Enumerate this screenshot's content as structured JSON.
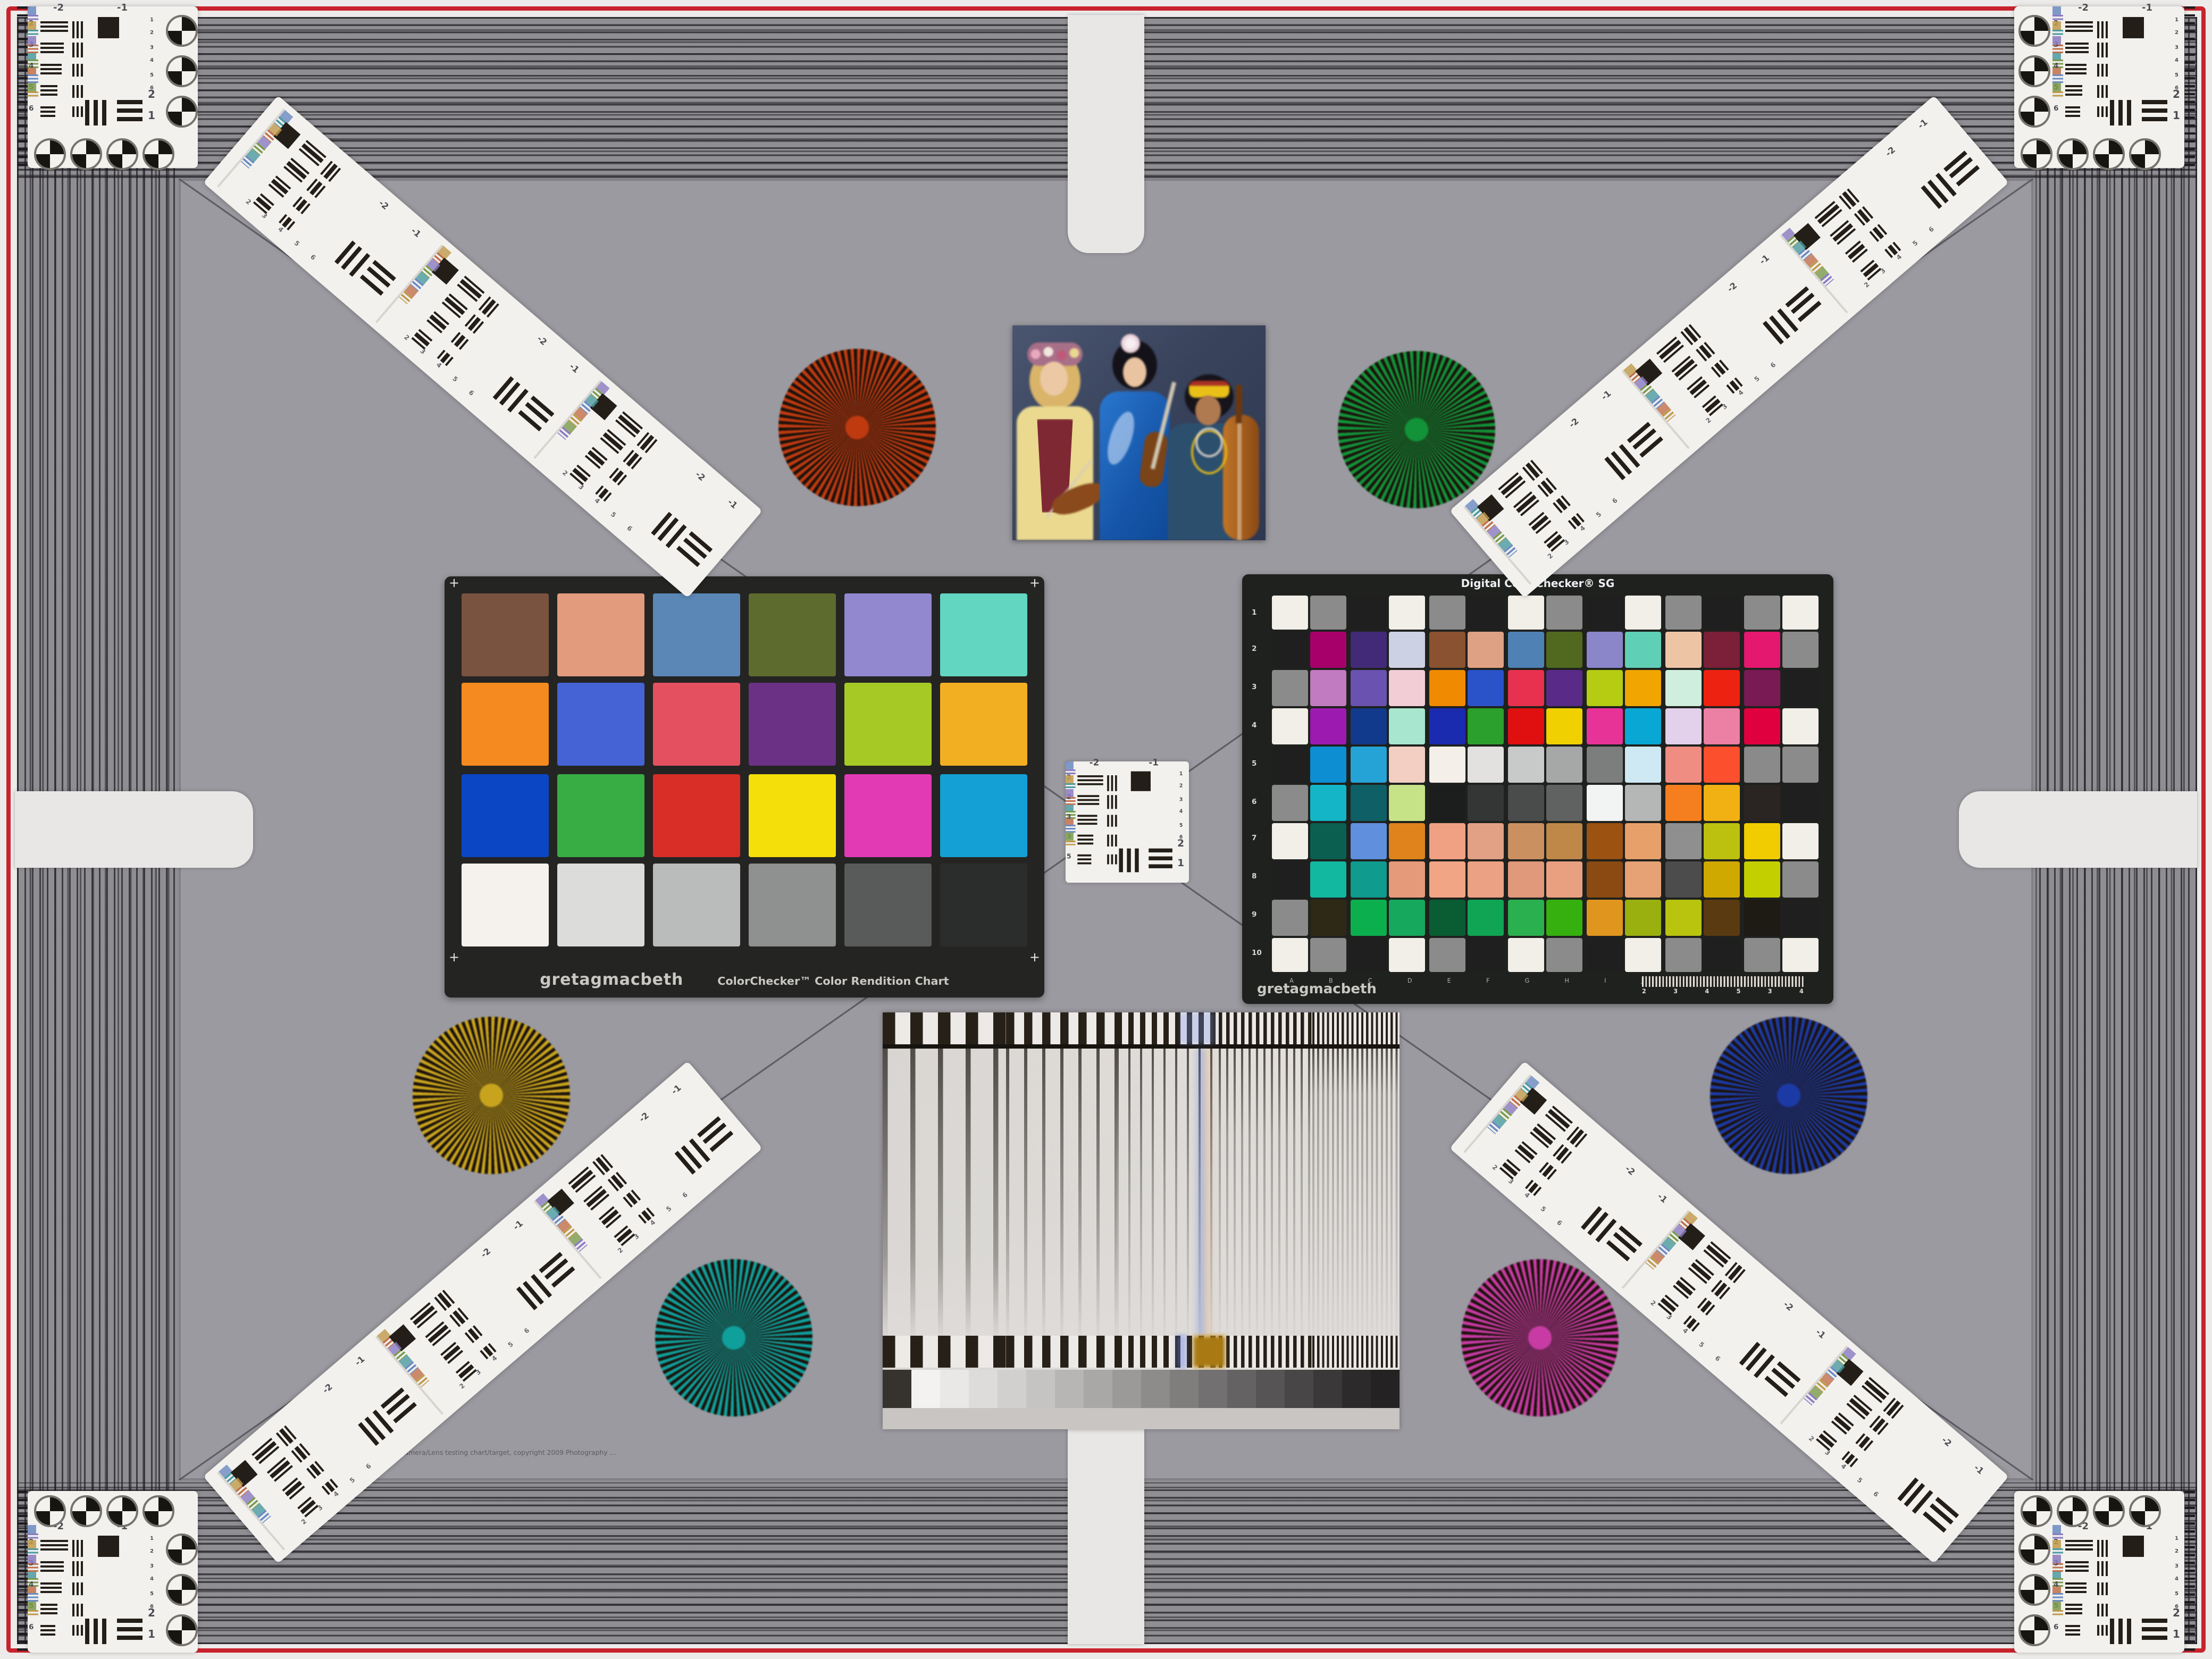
{
  "page": {
    "type": "camera-lens-test-chart"
  },
  "colors": {
    "frame_red": "#c8232c",
    "background_gray": "#8f8e93",
    "inner_gray": "#9b9aa0",
    "panel_white": "#f3f1ed",
    "chart_frame_black": "#242423"
  },
  "classic_checker": {
    "brand": "gretagmacbeth",
    "title": "ColorChecker™ Color Rendition Chart",
    "corner_marks": "+",
    "rows": [
      [
        "#7a5240",
        "#e29b7d",
        "#5a87b5",
        "#5d6b2e",
        "#9288cf",
        "#62d6c0"
      ],
      [
        "#f58a20",
        "#4663d5",
        "#e55060",
        "#6b3184",
        "#a6c926",
        "#f3af22"
      ],
      [
        "#0b46c4",
        "#38ad43",
        "#d92e28",
        "#f5df0a",
        "#e23ab4",
        "#14a0d4"
      ],
      [
        "#f5f2ed",
        "#dcdcda",
        "#b9bcbb",
        "#8e918f",
        "#585b59",
        "#2b2d2c"
      ]
    ]
  },
  "sg_checker": {
    "title": "Digital ColorChecker® SG",
    "brand": "gretagmacbeth",
    "row_labels": [
      "1",
      "2",
      "3",
      "4",
      "5",
      "6",
      "7",
      "8",
      "9",
      "10"
    ],
    "col_labels": [
      "A",
      "B",
      "C",
      "D",
      "E",
      "F",
      "G",
      "H",
      "I",
      "J",
      "K",
      "L",
      "M",
      "N"
    ],
    "wedge_numbers": [
      "2",
      "3",
      "4",
      "5",
      "3",
      "4"
    ],
    "rows": [
      [
        "#f2efe9",
        "#8b8b8b",
        "#1f1f1f",
        "#f2efe9",
        "#8b8b8b",
        "#1f1f1f",
        "#f2efe9",
        "#8b8b8b",
        "#1f1f1f",
        "#f2efe9",
        "#8b8b8b",
        "#1f1f1f",
        "#8b8b8b",
        "#f2efe9"
      ],
      [
        "#1f1f1f",
        "#a8006b",
        "#422a79",
        "#ccd1e3",
        "#8a5230",
        "#dfa183",
        "#4f81b5",
        "#51691f",
        "#8b85c9",
        "#5fd0b6",
        "#eec5a4",
        "#7c1f38",
        "#e3186e",
        "#8b8b8b"
      ],
      [
        "#8b8b8b",
        "#c17bc0",
        "#6a52b0",
        "#f3cdd5",
        "#f08a00",
        "#2a52c9",
        "#e8314e",
        "#5a2a88",
        "#b5cc12",
        "#f0a500",
        "#cfeedd",
        "#ee2211",
        "#7a1a55",
        "#1f1f1f"
      ],
      [
        "#f2efe9",
        "#9c1ab0",
        "#123a8c",
        "#a8e6cf",
        "#1b2bb0",
        "#2ca02c",
        "#e01010",
        "#f0d000",
        "#e73397",
        "#09a8d4",
        "#e3d0ea",
        "#ec7fa4",
        "#e00040",
        "#f2efe9"
      ],
      [
        "#1f1f1f",
        "#0d8ed3",
        "#26a3d6",
        "#f2cfc2",
        "#f4efe9",
        "#e2e1e0",
        "#c8c9c9",
        "#a6a7a7",
        "#7c7d7d",
        "#cfe9f4",
        "#f08d82",
        "#fb4f2e",
        "#8a8a8a",
        "#8b8b8b"
      ],
      [
        "#8b8b8b",
        "#14b5c6",
        "#0e5f66",
        "#c6e387",
        "#1c1e1d",
        "#343635",
        "#4a4c4b",
        "#606262",
        "#f2f4f3",
        "#b5b7b6",
        "#f57f1e",
        "#f2b112",
        "#2a2422",
        "#1f1f1f"
      ],
      [
        "#f2efe9",
        "#0b5f50",
        "#6090dd",
        "#e0831c",
        "#f0a183",
        "#e2a085",
        "#cb9060",
        "#c08848",
        "#9c5210",
        "#e8a06a",
        "#8e8f8e",
        "#bcc110",
        "#f0cc00",
        "#f2efe9"
      ],
      [
        "#1f1f1f",
        "#12b8a0",
        "#0f9b8d",
        "#e59a79",
        "#f2a585",
        "#eba184",
        "#e0997a",
        "#e8a080",
        "#8a4a12",
        "#e6a175",
        "#4c4c4c",
        "#cfa800",
        "#c4cf00",
        "#8b8b8b"
      ],
      [
        "#8b8b8b",
        "#2e2916",
        "#0caf4e",
        "#16a85c",
        "#0a5c32",
        "#0fa554",
        "#2ab04e",
        "#36b00e",
        "#e0951e",
        "#9ab00e",
        "#b8c40e",
        "#5a3a10",
        "#1e1a14",
        "#1f1f1f"
      ],
      [
        "#f2efe9",
        "#8b8b8b",
        "#1f1f1f",
        "#f2efe9",
        "#8b8b8b",
        "#1f1f1f",
        "#f2efe9",
        "#8b8b8b",
        "#1f1f1f",
        "#f2efe9",
        "#8b8b8b",
        "#1f1f1f",
        "#8b8b8b",
        "#f2efe9"
      ]
    ]
  },
  "resolution_targets": {
    "group_labels": [
      "-2",
      "-1"
    ],
    "corner_left_numbers": [
      "2",
      "3",
      "4",
      "5",
      "6"
    ],
    "center_left_numbers": [
      "2",
      "2",
      "3",
      "3",
      "5"
    ],
    "right_numbers": [
      "1",
      "2",
      "3",
      "4",
      "5",
      "6"
    ],
    "bottom_numbers": [
      "2",
      "1"
    ]
  },
  "starbursts": [
    {
      "name": "red",
      "color": "#c03a10"
    },
    {
      "name": "green",
      "color": "#129339"
    },
    {
      "name": "yellow",
      "color": "#c8a41e"
    },
    {
      "name": "blue",
      "color": "#1c3aa6"
    },
    {
      "name": "teal",
      "color": "#10a09c"
    },
    {
      "name": "magenta",
      "color": "#c93ba4"
    }
  ],
  "sweep_chart": {
    "gray_steps": [
      "#36322e",
      "#f4f2f0",
      "#eae8e6",
      "#dedcda",
      "#d2d0ce",
      "#c6c4c2",
      "#b8b6b4",
      "#aaa8a6",
      "#9c9a98",
      "#8e8c8a",
      "#807e7c",
      "#727070",
      "#646262",
      "#565454",
      "#484646",
      "#3a3838",
      "#2c2a2a",
      "#242222"
    ]
  },
  "footer": {
    "copyright": "Camera/Lens testing chart/target, copyright 2009 Photography …"
  }
}
